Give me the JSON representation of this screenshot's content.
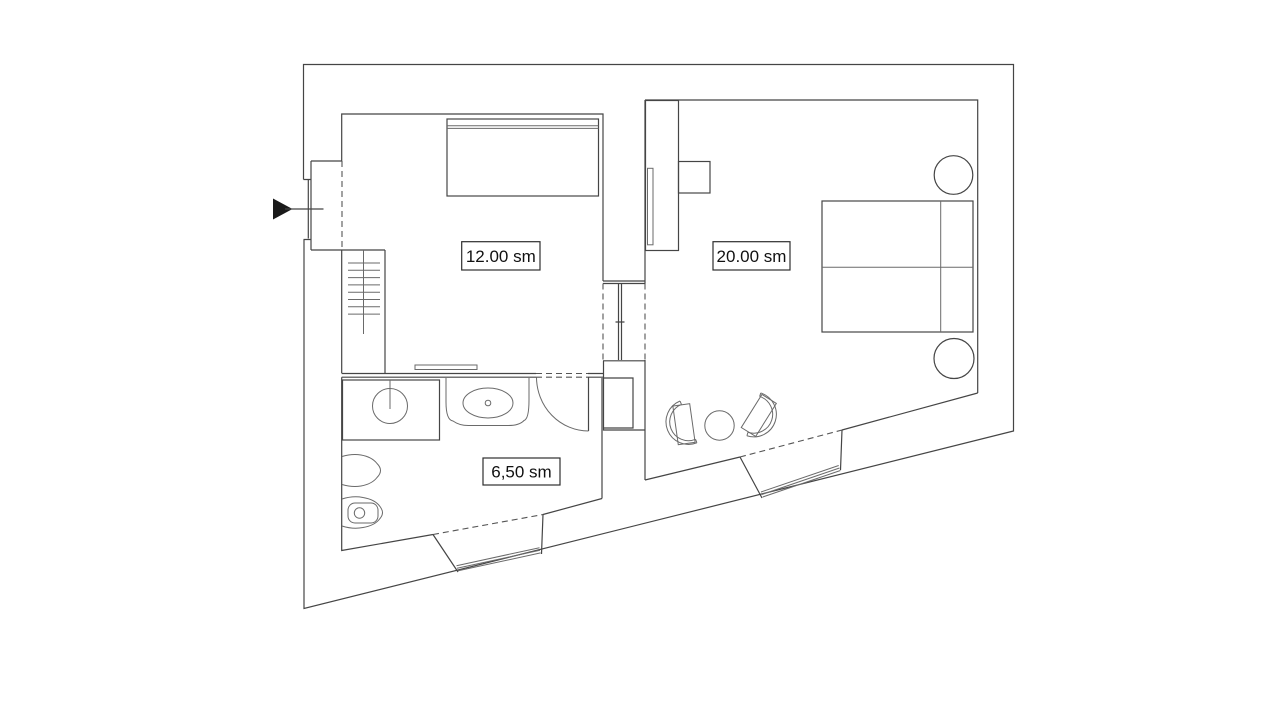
{
  "plan": {
    "type": "apartment-floor-plan",
    "background_color": "#ffffff",
    "line_color": "#454545",
    "area_unit": "sm",
    "rooms": [
      {
        "name": "living-room",
        "area_label": "12.00 sm",
        "fixtures": [
          "sofa-bed",
          "wall-shelf",
          "staircase",
          "entrance-vestibule"
        ]
      },
      {
        "name": "bedroom",
        "area_label": "20.00 sm",
        "fixtures": [
          "wardrobe",
          "side-table",
          "double-bed",
          "round-nightstand",
          "round-nightstand",
          "armchair",
          "armchair",
          "coffee-table",
          "window"
        ]
      },
      {
        "name": "bathroom",
        "area_label": "6,50 sm",
        "fixtures": [
          "vanity-counter-sink",
          "washbasin",
          "toilet",
          "bidet",
          "swing-door",
          "window"
        ]
      }
    ],
    "entrance": {
      "marker": "arrow-right",
      "side": "left"
    }
  }
}
